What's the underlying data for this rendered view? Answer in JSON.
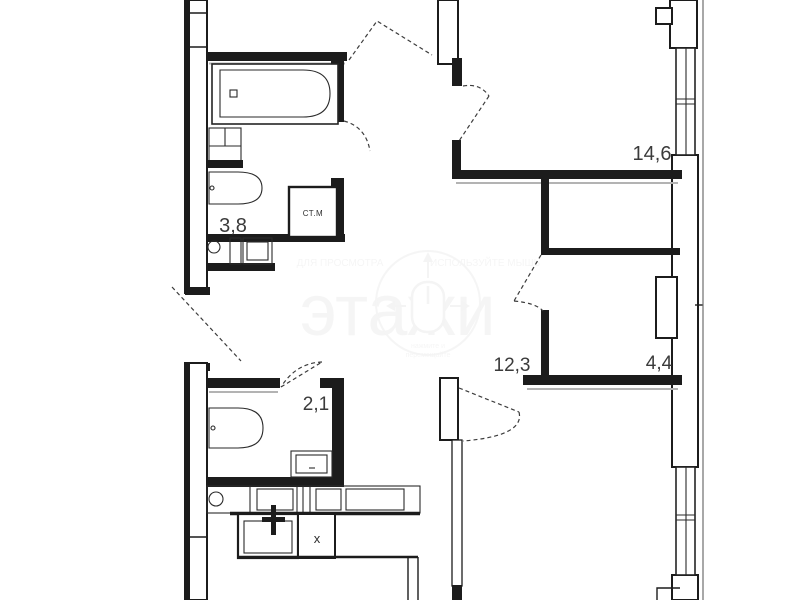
{
  "floor_plan": {
    "rooms": [
      {
        "id": "bathroom-top",
        "area": "3,8"
      },
      {
        "id": "living-room-right",
        "area": "14,6"
      },
      {
        "id": "hallway",
        "area": "12,3"
      },
      {
        "id": "storage-room",
        "area": "4,4"
      },
      {
        "id": "bathroom-bottom",
        "area": "2,1"
      }
    ],
    "fixtures": {
      "washing_machine_label": "СТ.М",
      "stove_label": "x"
    },
    "watermark": {
      "line_left": "ДЛЯ ПРОСМОТРА",
      "line_right": "ИСПОЛЬЗУЙТЕ МЫШЬ",
      "brand": "этажи",
      "hint_line1": "нажмите и",
      "hint_line2": "перемещайте"
    },
    "colors": {
      "wall": "#1c1c1c",
      "shadow_line": "#b3b3b3",
      "label": "#3b3b3b",
      "watermark": "#9a9a9a",
      "background": "#ffffff"
    }
  }
}
